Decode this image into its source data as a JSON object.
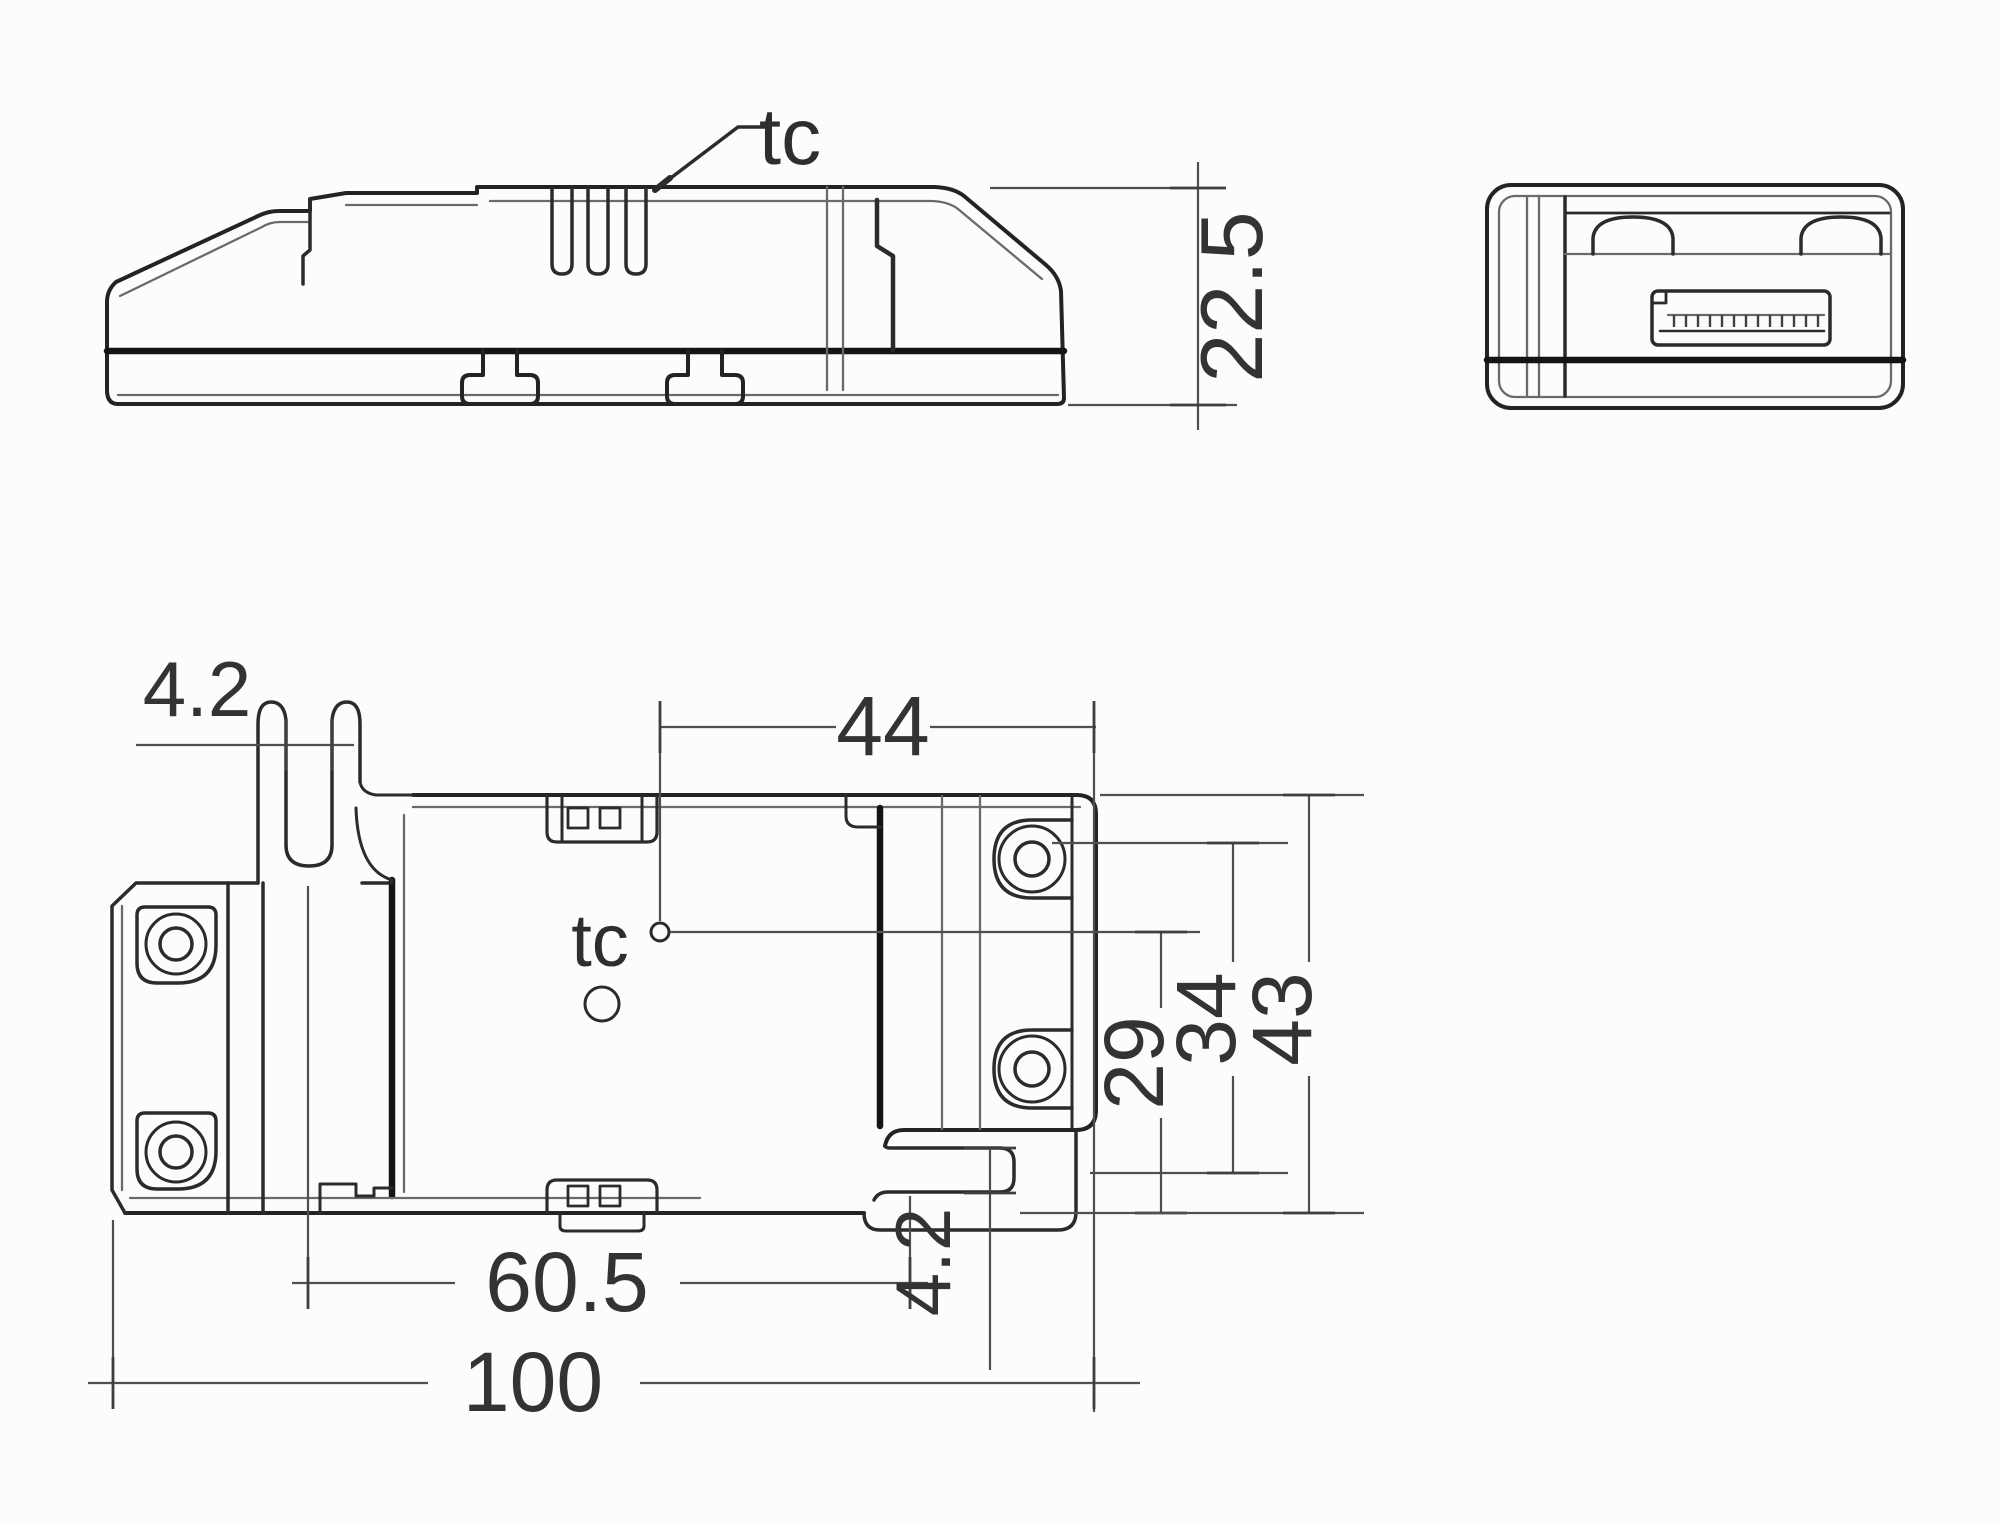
{
  "drawing": {
    "kind": "technical dimension drawing",
    "views": {
      "side": {
        "tc_label": "tc",
        "height": "22.5"
      },
      "end": {
        "name": "end view"
      },
      "plan": {
        "tc_label": "tc",
        "keyhole_slot_width": "4.2",
        "tc_offset_x": "44",
        "tc_offset_y": "29",
        "inner_height": "34",
        "overall_height": "43",
        "fixing_centres": "60.5",
        "hook_slot_width": "4.2",
        "overall_length": "100"
      }
    },
    "colors": {
      "background": "#fcfcfc",
      "line": "#2b2b2b",
      "line_heavy": "#141414",
      "line_light": "#6a6a6a",
      "dimension": "#4f4f4f",
      "text": "#333333"
    }
  }
}
